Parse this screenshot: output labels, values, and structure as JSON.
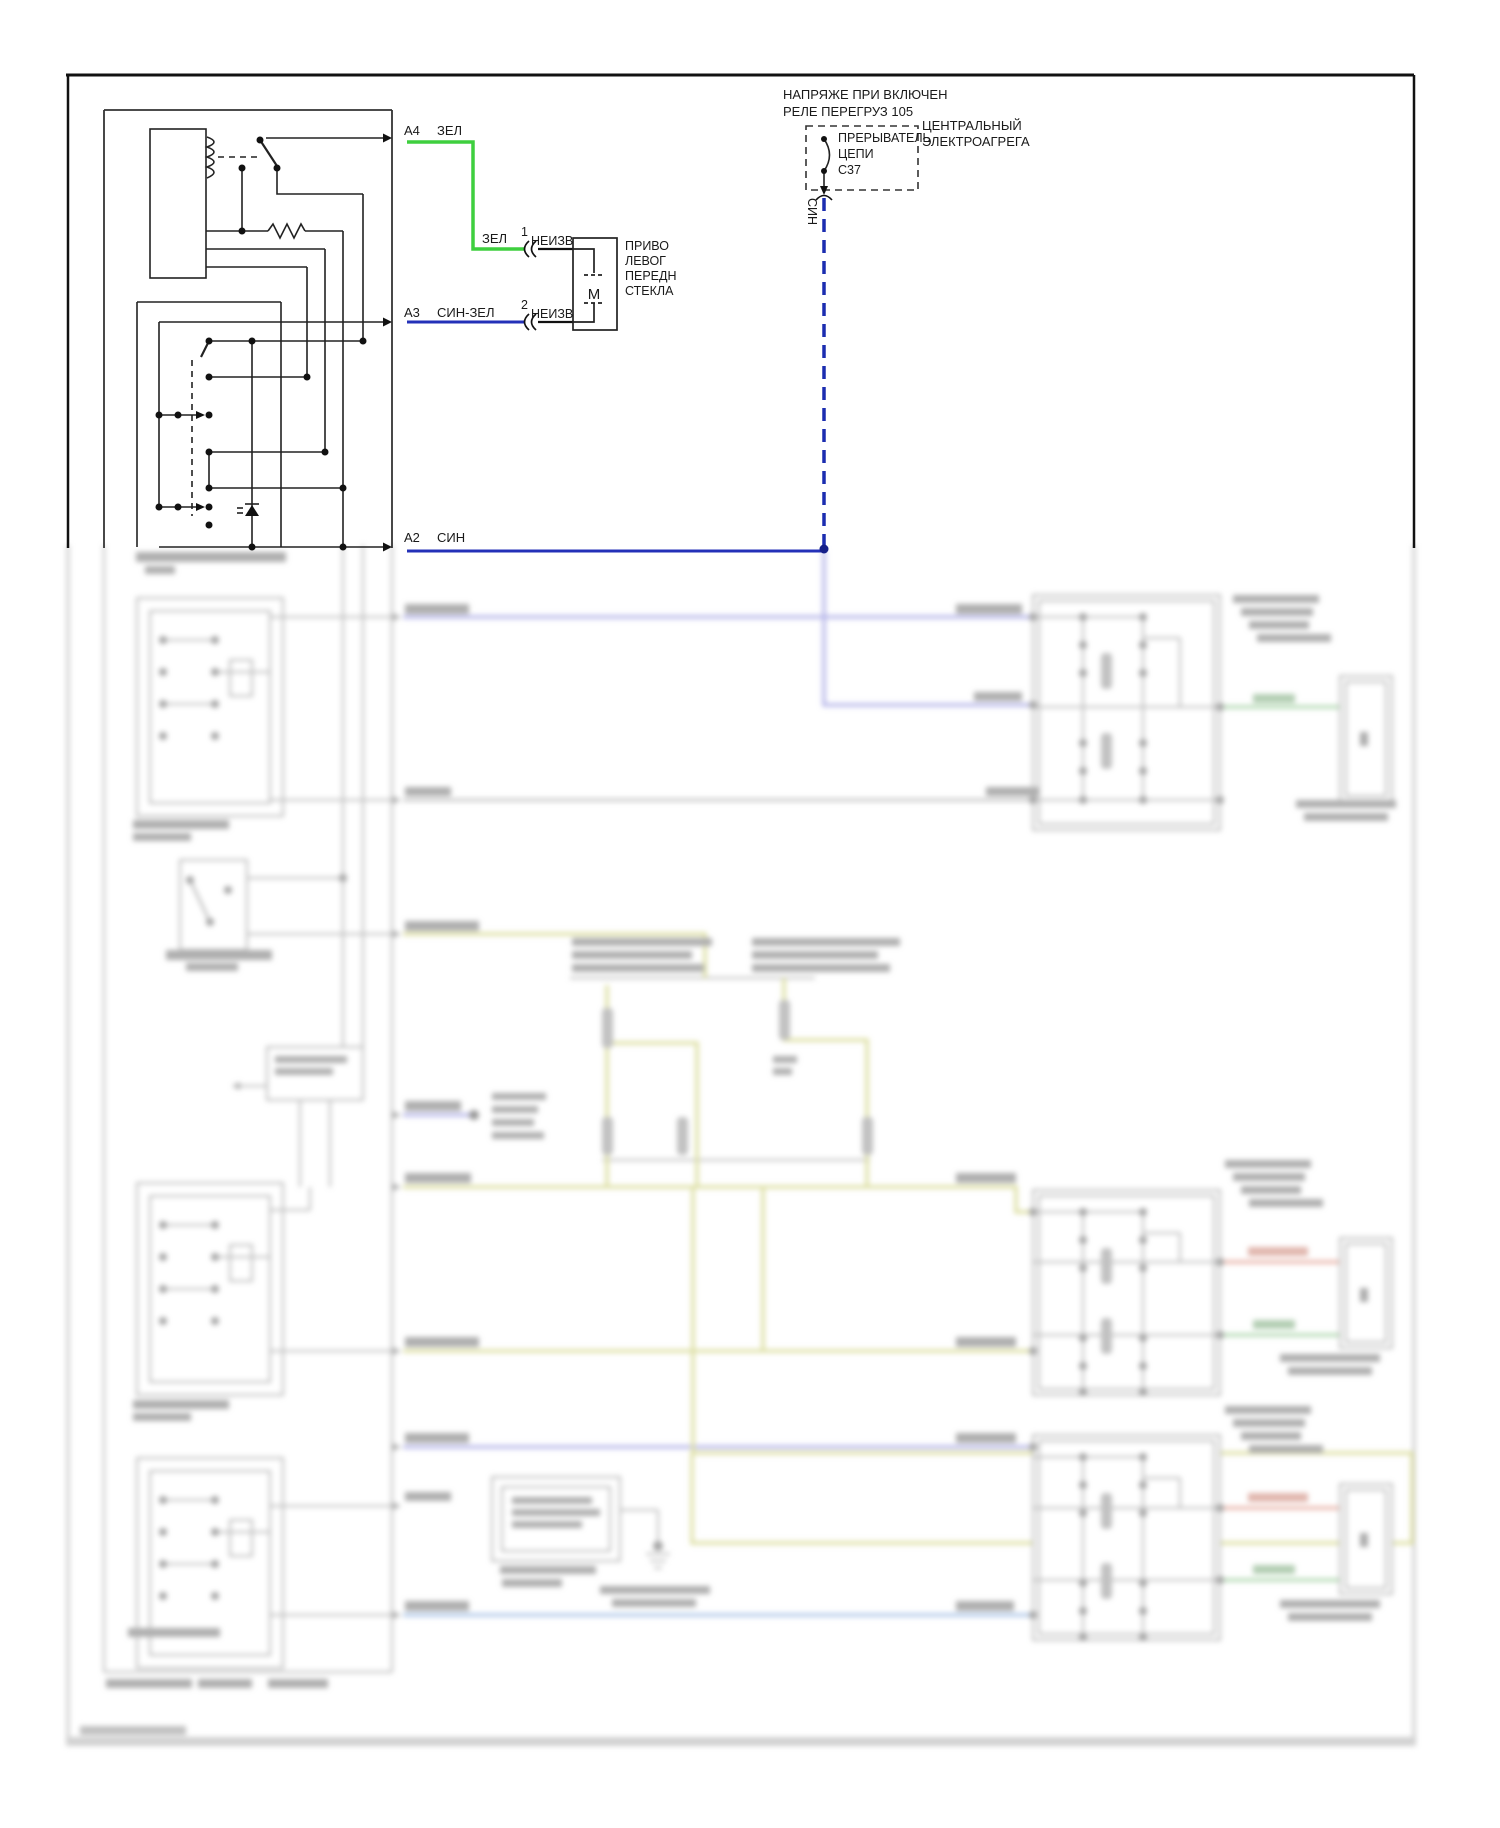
{
  "page": {
    "background": "#ffffff",
    "border_color": "#111111"
  },
  "colors": {
    "green_wire": "#3ecf3e",
    "blue_wire": "#2431b8",
    "faded_periwinkle": "#8b8bdc",
    "faded_olive": "#c9cc6e",
    "faded_green": "#86c386",
    "faded_red": "#dd8b7a",
    "faded_light_blue": "#7fa7dc",
    "faded_gray": "#909090"
  },
  "labels": {
    "a4_pin": "A4",
    "a4_color": "ЗЕЛ",
    "w1_color": "ЗЕЛ",
    "w1_num": "1",
    "w1_name": "НЕИЗВ",
    "w2_num": "2",
    "w2_name": "НЕИЗВ",
    "a3_pin": "A3",
    "a3_color": "СИН-ЗЕЛ",
    "a2_pin": "A2",
    "a2_color": "СИН",
    "motor_l1": "ПРИВО",
    "motor_l2": "ЛЕВОГ",
    "motor_l3": "ПЕРЕДН",
    "motor_l4": "СТЕКЛА",
    "motor_letter": "M",
    "note_l1": "НАПРЯЖЕ ПРИ ВКЛЮЧЕН",
    "note_l2": "РЕЛЕ ПЕРЕГРУЗ 105",
    "breaker_l1": "ПРЕРЫВАТЕЛЬ",
    "breaker_l2": "ЦЕПИ",
    "breaker_id": "C37",
    "unit_l1": "ЦЕНТРАЛЬНЫЙ",
    "unit_l2": "ЭЛЕКТРОАГРЕГА",
    "sin_vertical": "СИН"
  }
}
